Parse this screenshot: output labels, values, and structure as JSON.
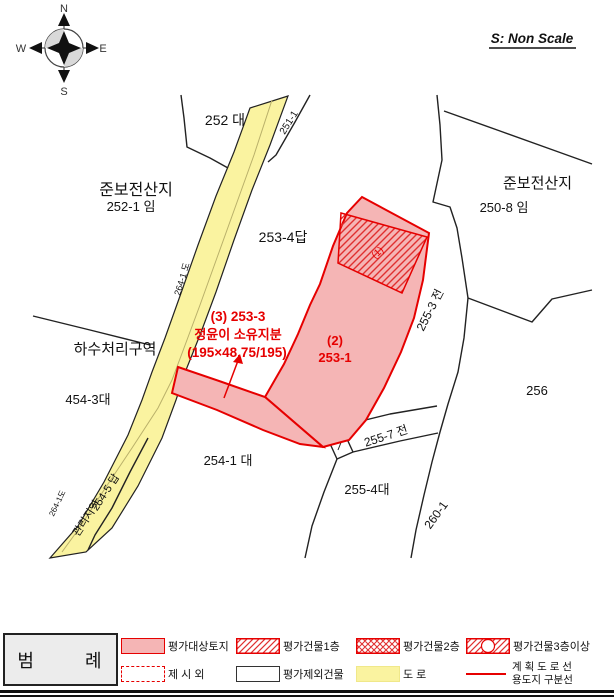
{
  "scale_note": "S: Non Scale",
  "compass": {
    "north": "N",
    "south": "S",
    "east": "E",
    "west": "W"
  },
  "colors": {
    "red": "#e60000",
    "parcel_fill": "#f5b5b5",
    "road_yellow": "#faf3a0",
    "hatch_red": "#e03030",
    "legend_bg": "#ececec"
  },
  "map_labels": [
    {
      "text": "252 대"
    },
    {
      "text": "준보전산지"
    },
    {
      "text": "252-1 임"
    },
    {
      "text": "준보전산지"
    },
    {
      "text": "250-8 임"
    },
    {
      "text": "253-4답"
    },
    {
      "text": "(1)"
    },
    {
      "text": "(3) 253-3"
    },
    {
      "text": "정윤이 소유지분"
    },
    {
      "text": "(195×48.75/195)"
    },
    {
      "text": "(2)"
    },
    {
      "text": "253-1"
    },
    {
      "text": "255-3 전"
    },
    {
      "text": "하수처리구역"
    },
    {
      "text": "454-3대"
    },
    {
      "text": "254-1 대"
    },
    {
      "text": "255-7 전"
    },
    {
      "text": "255-4대"
    },
    {
      "text": "256"
    },
    {
      "text": "260-1"
    },
    {
      "text": "254-5 답"
    },
    {
      "text": "관리지역"
    },
    {
      "text": "264-1 도"
    },
    {
      "text": "264-1도"
    },
    {
      "text": "251-1"
    }
  ],
  "legend": {
    "title": "범       례",
    "items": {
      "target_parcel": "평가대상토지",
      "bldg1": "평가건물1층",
      "bldg2": "평가건물2층",
      "bldg3": "평가건물3층이상",
      "jesi": "제 시 외",
      "excluded": "평가제외건물",
      "road": "도 로",
      "planned_road": "계 획 도 로 선",
      "use_boundary": "용도지 구분선"
    }
  }
}
